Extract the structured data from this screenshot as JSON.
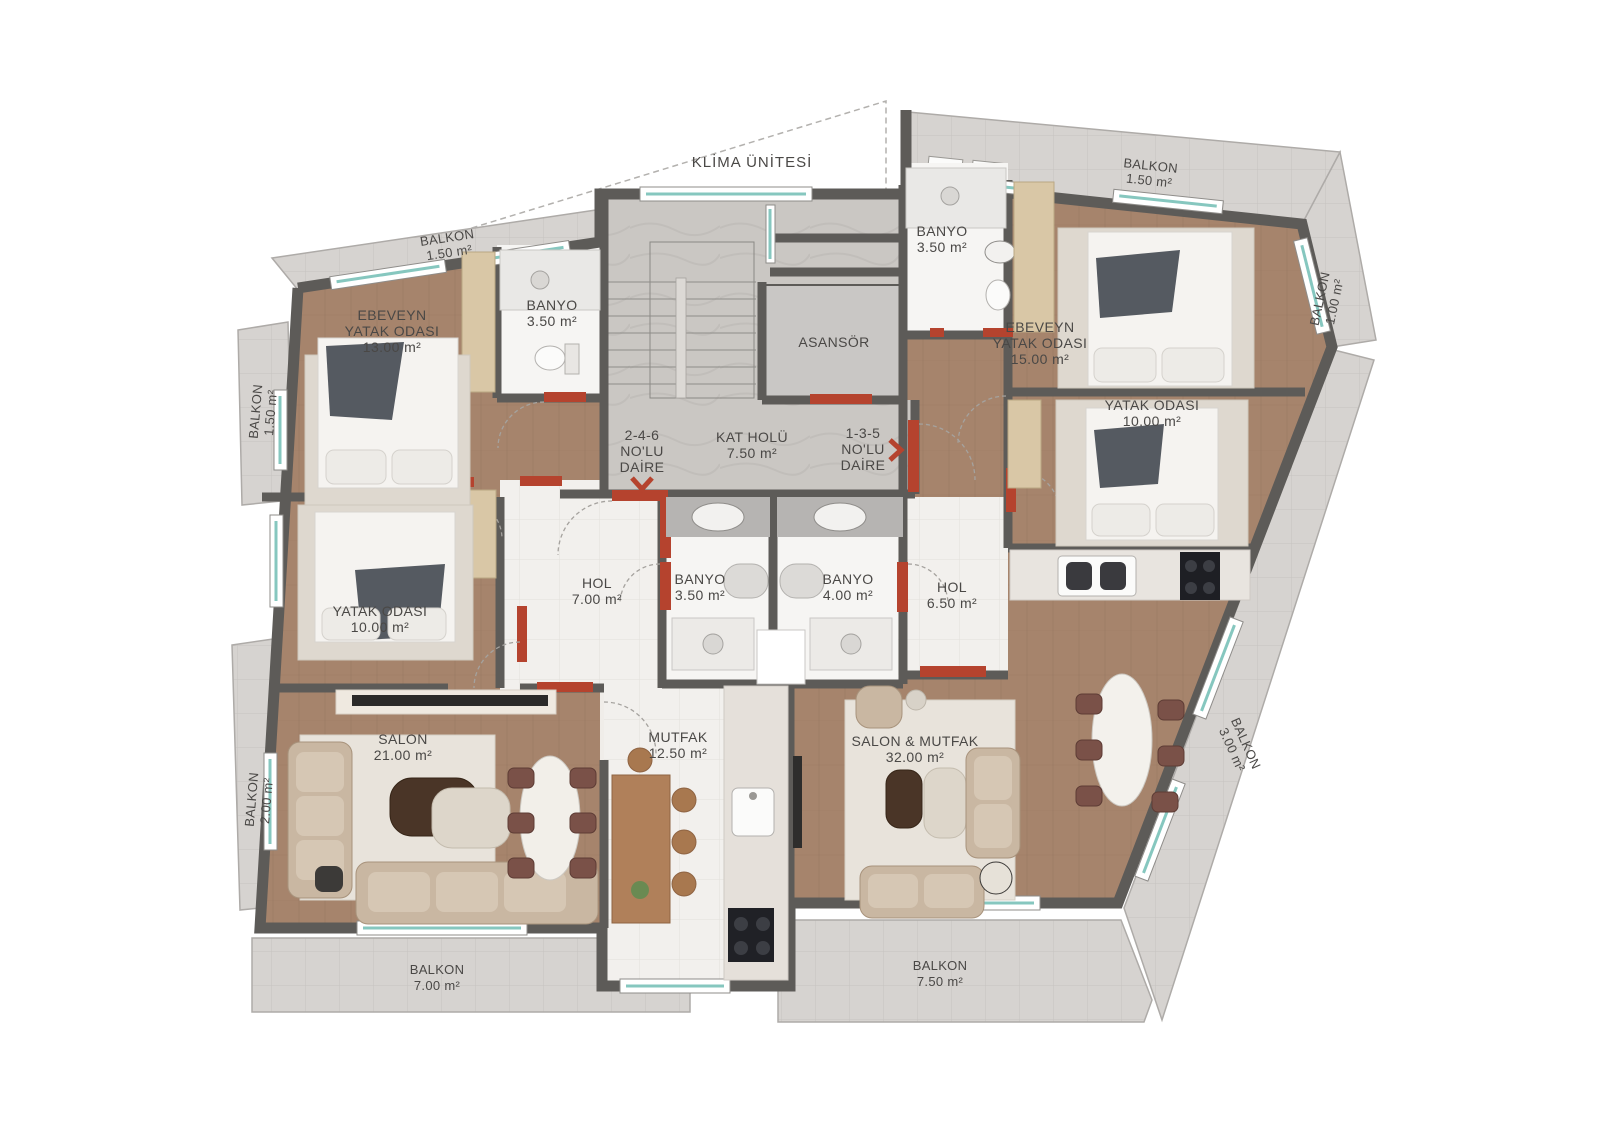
{
  "plan": {
    "klima_label": "KLİMA ÜNİTESİ",
    "core": {
      "asansor": "ASANSÖR",
      "kat_holu": {
        "name": "KAT HOLÜ",
        "area": "7.50 m²"
      },
      "daire_246": {
        "line1": "2-4-6",
        "line2": "NO'LU",
        "line3": "DAİRE"
      },
      "daire_135": {
        "line1": "1-3-5",
        "line2": "NO'LU",
        "line3": "DAİRE"
      }
    },
    "apartment_246": {
      "ebeveyn": {
        "line1": "EBEVEYN",
        "line2": "YATAK ODASI",
        "area": "13.00 m²"
      },
      "banyo_ust": {
        "name": "BANYO",
        "area": "3.50 m²"
      },
      "yatak": {
        "name": "YATAK ODASI",
        "area": "10.00 m²"
      },
      "hol": {
        "name": "HOL",
        "area": "7.00 m²"
      },
      "banyo": {
        "name": "BANYO",
        "area": "3.50 m²"
      },
      "salon": {
        "name": "SALON",
        "area": "21.00 m²"
      },
      "mutfak": {
        "name": "MUTFAK",
        "area": "12.50 m²"
      }
    },
    "apartment_135": {
      "banyo_ust": {
        "name": "BANYO",
        "area": "3.50 m²"
      },
      "ebeveyn": {
        "line1": "EBEVEYN",
        "line2": "YATAK ODASI",
        "area": "15.00 m²"
      },
      "yatak": {
        "name": "YATAK ODASI",
        "area": "10.00 m²"
      },
      "hol": {
        "name": "HOL",
        "area": "6.50 m²"
      },
      "banyo": {
        "name": "BANYO",
        "area": "4.00 m²"
      },
      "salon_mutfak": {
        "name": "SALON & MUTFAK",
        "area": "32.00 m²"
      }
    },
    "balconies": {
      "top_left": {
        "name": "BALKON",
        "area": "1.50 m²"
      },
      "left_upper": {
        "name": "BALKON",
        "area": "1.50 m²"
      },
      "left_lower": {
        "name": "BALKON",
        "area": "2.00 m²"
      },
      "bottom_left": {
        "name": "BALKON",
        "area": "7.00 m²"
      },
      "bottom_right": {
        "name": "BALKON",
        "area": "7.50 m²"
      },
      "right_lower": {
        "name": "BALKON",
        "area": "3.00 m²"
      },
      "right_upper": {
        "name": "BALKON",
        "area": "1.00 m²"
      },
      "top_right": {
        "name": "BALKON",
        "area": "1.50 m²"
      }
    },
    "colors": {
      "wall": "#5d5b58",
      "wood": "#a6846c",
      "tile": "#f2f0ed",
      "marble": "#cac7c3",
      "balcony": "#d6d3d0",
      "accent_red": "#b5432e",
      "window_teal": "#86c7bf",
      "text": "#4a4846"
    }
  }
}
